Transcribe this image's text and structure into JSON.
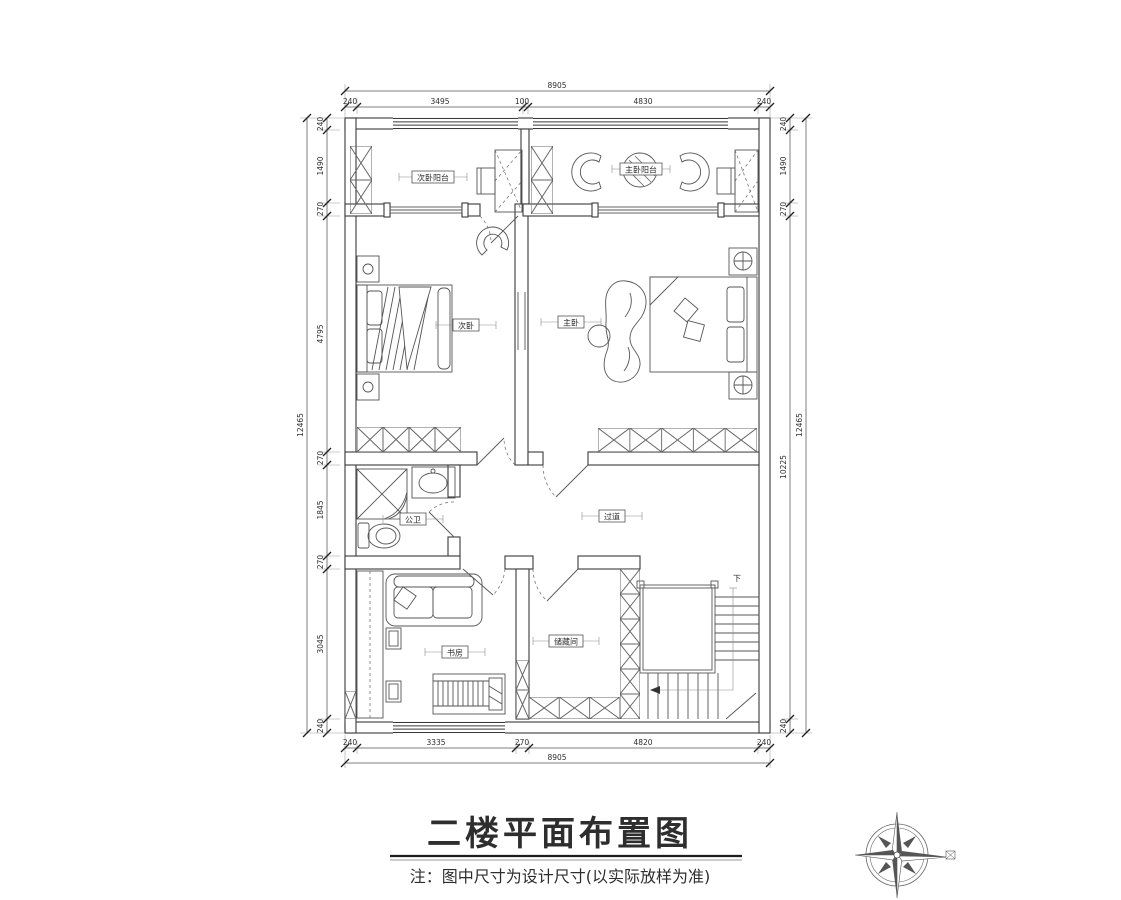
{
  "title": "二楼平面布置图",
  "note": "注：图中尺寸为设计尺寸(以实际放样为准)",
  "rooms": {
    "balcony_left": "次卧阳台",
    "balcony_right": "主卧阳台",
    "bedroom_left": "次卧",
    "bedroom_right": "主卧",
    "bathroom": "公卫",
    "hallway": "过道",
    "study": "书房",
    "storage": "储藏间"
  },
  "stairs": {
    "down_label": "下"
  },
  "dimensions": {
    "top": {
      "overall": "8905",
      "segments": [
        "240",
        "3495",
        "100",
        "4830",
        "240"
      ]
    },
    "bottom": {
      "overall": "8905",
      "segments": [
        "240",
        "3335",
        "270",
        "4820",
        "240"
      ]
    },
    "left": {
      "overall": "12465",
      "segments": [
        "240",
        "1490",
        "270",
        "4795",
        "270",
        "1845",
        "270",
        "3045",
        "240"
      ]
    },
    "right": {
      "overall": "12465",
      "segments": [
        "240",
        "1490",
        "270",
        "10225",
        "240"
      ]
    }
  },
  "colors": {
    "line": "#3a3a3a",
    "background": "#ffffff"
  }
}
